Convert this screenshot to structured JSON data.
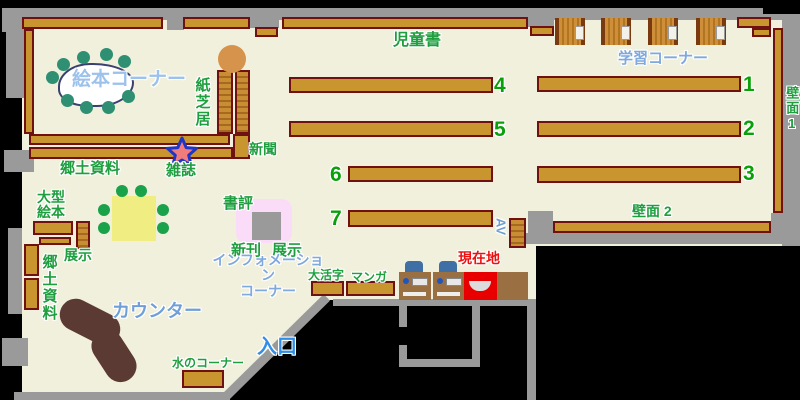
{
  "map": {
    "title": "library-floor-map",
    "areas": {
      "ehon_corner": "絵本コーナー",
      "kamishibai": "紙芝居",
      "shinbun": "新聞",
      "zasshi": "雑誌",
      "kyodo_shiryo_top": "郷土資料",
      "ogata_ehon": "大型\n絵本",
      "tenji_left": "展示",
      "kyodo_shiryo_left": "郷土資料",
      "jidosho": "児童書",
      "gakushu_corner": "学習コーナー",
      "hekimen1": "壁面1",
      "hekimen2": "壁面 2",
      "shohyo": "書評",
      "shinkan": "新刊",
      "tenji_center": "展示",
      "information": "インフォメーション\nコーナー",
      "daikatsuji": "大活字",
      "manga": "マンガ",
      "genzaichi": "現在地",
      "counter": "カウンター",
      "mizu_corner": "水のコーナー",
      "iriguchi": "入口",
      "av": "AV"
    },
    "shelf_numbers": [
      "1",
      "2",
      "3",
      "4",
      "5",
      "6",
      "7"
    ],
    "colors": {
      "floor": "#f1f0dd",
      "shelf": "#c9952e",
      "shelf_border": "#701111",
      "wall": "#9a9a9a",
      "label_green": "#1f9e3f",
      "label_blue": "#7fa8dc",
      "current_location_red": "#ee0000",
      "counter_brown": "#5b3a33",
      "table_yellow": "#f0ee82",
      "pink_area": "#fadcf8"
    }
  }
}
